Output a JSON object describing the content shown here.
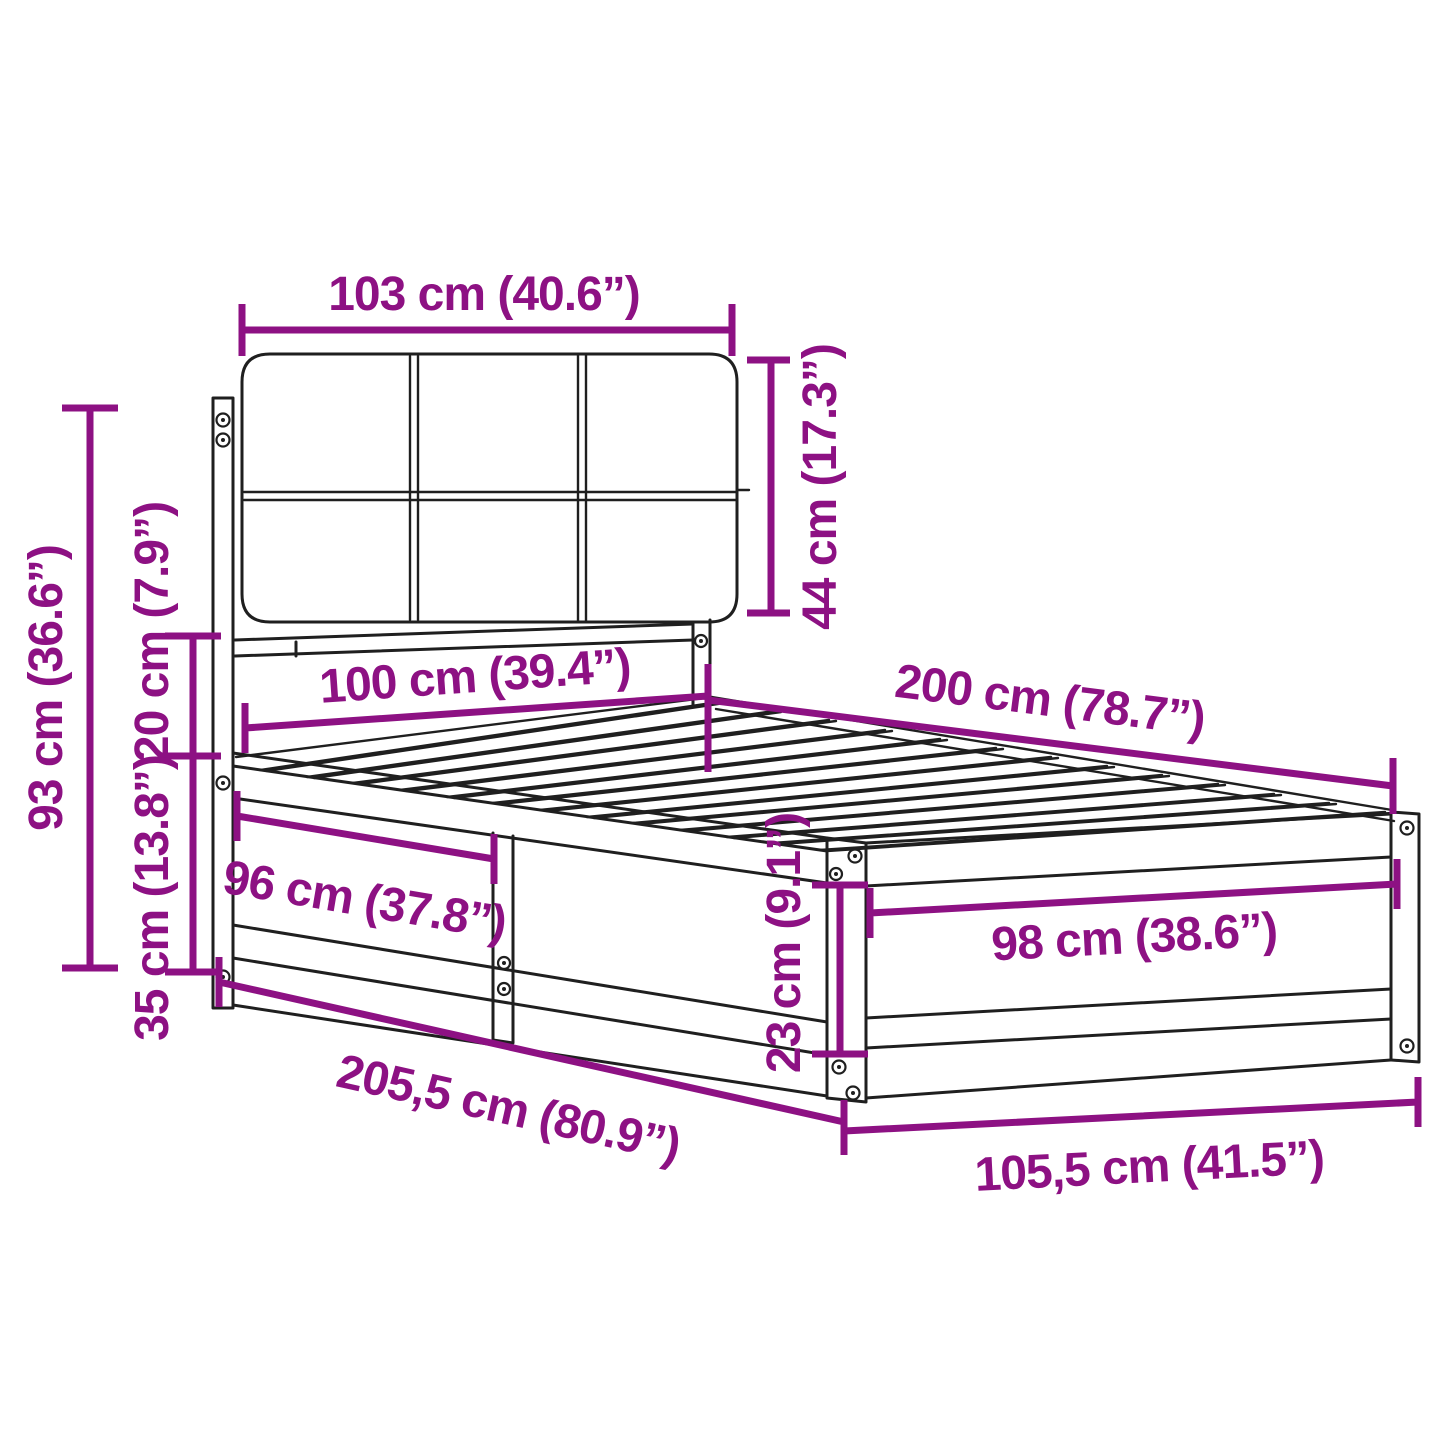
{
  "diagram": {
    "kind": "bed-frame-with-upholstered-headboard-dimension-diagram",
    "colors": {
      "dimension_annotation": "#8d1183",
      "line_art": "#1f1f1f",
      "background": "#ffffff"
    },
    "dimensions": {
      "headboard_width": "103 cm (40.6”)",
      "headboard_cushion_height": "44 cm (17.3”)",
      "headboard_total_height": "93 cm (36.6”)",
      "cushion_to_frame_gap": "20 cm (7.9”)",
      "frame_base_height": "35 cm (13.8”)",
      "bed_width": "100 cm (39.4”)",
      "bed_length": "200 cm (78.7”)",
      "side_rail_section_length": "96 cm (37.8”)",
      "footboard_inner_width": "98 cm (38.6”)",
      "side_rail_height": "23 cm (9.1”)",
      "total_length": "205,5 cm (80.9”)",
      "total_width": "105,5 cm (41.5”)"
    }
  }
}
